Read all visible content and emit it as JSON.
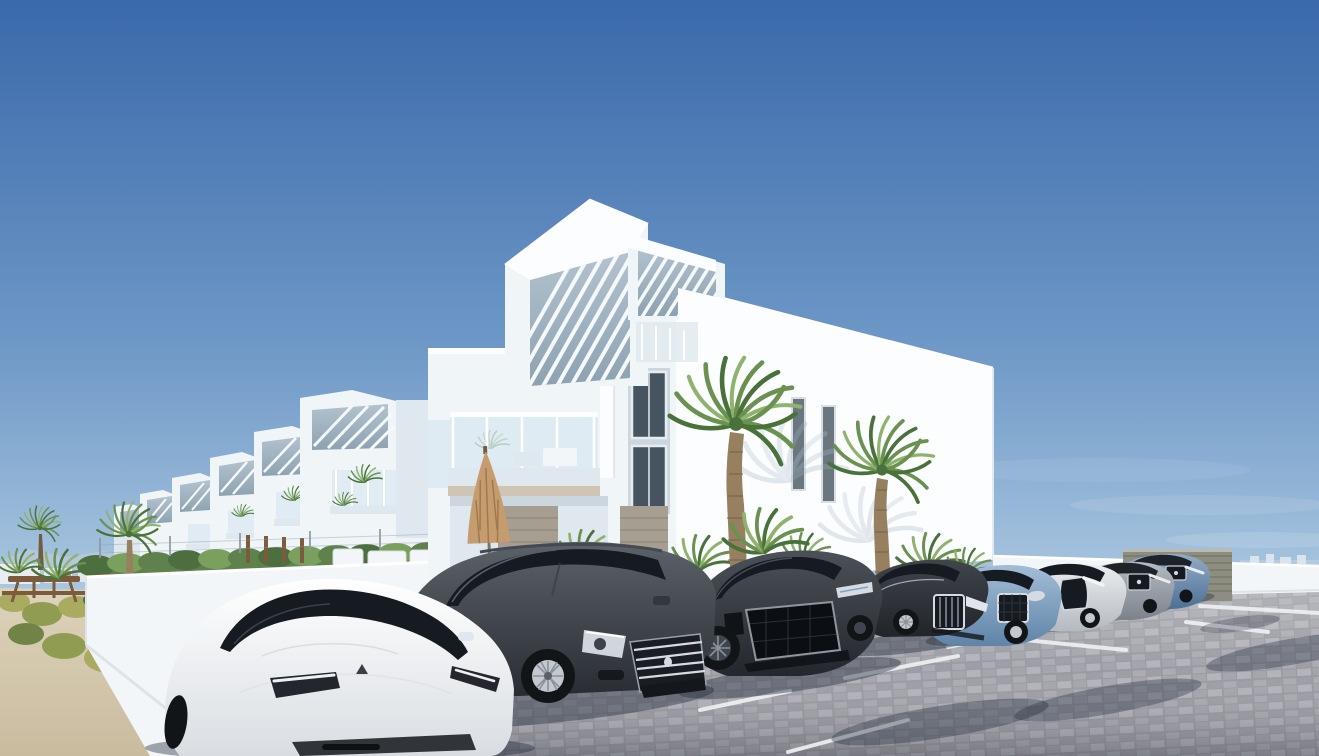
{
  "image": {
    "alt": "3D architectural render: modern white apartment complex with rooftop pergolas, palm trees, green hedges and a row of cars in a block-paved parking lot under a clear blue sky",
    "type": "architectural-render",
    "sky": "clear blue, hazy near horizon",
    "setting": "new-build residential development with parking"
  },
  "scene": {
    "main_building": "white three-storey apartment block with two slatted rooftop pergolas, glass balcony, tan patio umbrella and garage doors",
    "townhouse_row": "receding row of white townhouses with pergola roofs, glass balconies and planted terraces",
    "left_area": "sandy garden path with yellow-green shrubs, wooden picnic tables and fan palms",
    "right_area": "white perimeter wall with grey sliding gate, faint coastline on the horizon",
    "parking": "grey block-paved lot with white bay lines and cast car shadows",
    "hedge": "clipped green hedge over white garden wall with wire fence"
  },
  "vehicles": [
    {
      "name": "white-tesla-model-3",
      "color": "#f2f3f5"
    },
    {
      "name": "dark-grey-peugeot-508",
      "color": "#3c4148"
    },
    {
      "name": "dark-grey-audi-rs7",
      "color": "#34383f"
    },
    {
      "name": "black-audi-a8",
      "color": "#2c3036"
    },
    {
      "name": "light-blue-jaguar",
      "color": "#7fa3c4"
    },
    {
      "name": "silver-lexus",
      "color": "#ccd1d7"
    },
    {
      "name": "grey-mercedes",
      "color": "#99a0a8"
    },
    {
      "name": "blue-mercedes",
      "color": "#5d81a9"
    }
  ],
  "vegetation": [
    "two tall fan palms",
    "palm shrubs",
    "green hedge",
    "yellow-green shrubs",
    "distant palms"
  ],
  "palette": {
    "sky-top": "#3a69ab",
    "sky-mid": "#6d97c6",
    "sky-low": "#aac7e0",
    "sky-horizon": "#ddeaf2",
    "cloud": "#ffffff",
    "mountain": "#b7c9da",
    "town-a": "#e8edf1",
    "town-b": "#b08a68",
    "horizon-sea": "#c6d6e2",
    "white-sun": "#fcfdfe",
    "white-face": "#f0f5f8",
    "white-shade": "#dfe8ee",
    "white-dim": "#cbd6de",
    "perg-hi": "#b3c3cf",
    "perg-lo": "#8da2b0",
    "slat": "#f5f9fb",
    "window-pane": "#46545f",
    "window-frame": "#e6ecf0",
    "glass-blue": "#cfe2ed",
    "hedge-a": "#5f824d",
    "hedge-b": "#4d6e3f",
    "hedge-c": "#79a05c",
    "palm-a": "#6a9150",
    "palm-b": "#49713a",
    "palm-c": "#8fb36d",
    "trunk-a": "#96805f",
    "trunk-b": "#6f5c43",
    "sand-a": "#ddd3bb",
    "sand-b": "#c9bb9e",
    "shrub-a": "#a9ab60",
    "shrub-b": "#8f9c52",
    "shrub-c": "#6f8446",
    "wood-a": "#7c5a3c",
    "fence": "#8e99a4",
    "pave-grout": "#97989f",
    "pave-a": "#a9aab1",
    "pave-b": "#b1b2b9",
    "pave-c": "#a2a3aa",
    "pave-d": "#9b9ca3",
    "line-paint": "#eef0f2",
    "wall-a": "#f3f6f8",
    "wall-b": "#dde4e9",
    "gate-a": "#8d8e80",
    "gate-b": "#767868",
    "umb-a": "#c59c6e",
    "umb-b": "#9e7a4e",
    "door-a": "#a69e90",
    "door-b": "#938b7d",
    "tan-fascia": "#cfc5b4",
    "ts-hi": "#ffffff",
    "ts-lo": "#d9dde2",
    "pg-hi": "#5c6269",
    "pg-lo": "#292d33",
    "rs-hi": "#4b5158",
    "rs-lo": "#24272d",
    "a8-hi": "#40454c",
    "a8-lo": "#212429",
    "jg-hi": "#a3bdd6",
    "jg-lo": "#5f84a8",
    "lx-hi": "#eceef0",
    "lx-lo": "#b4bac1",
    "mg-hi": "#b4bac0",
    "mg-lo": "#7b828a",
    "mb-hi": "#93acc6",
    "mb-lo": "#4c6f96",
    "glass-dark": "#161b22",
    "chrome": "#d5dbe0",
    "tire": "#121518",
    "rim-light": "#c4c9cf",
    "rim-dark": "#3f454d",
    "spoke": "#8a9198",
    "shadow-c": "#273040"
  }
}
